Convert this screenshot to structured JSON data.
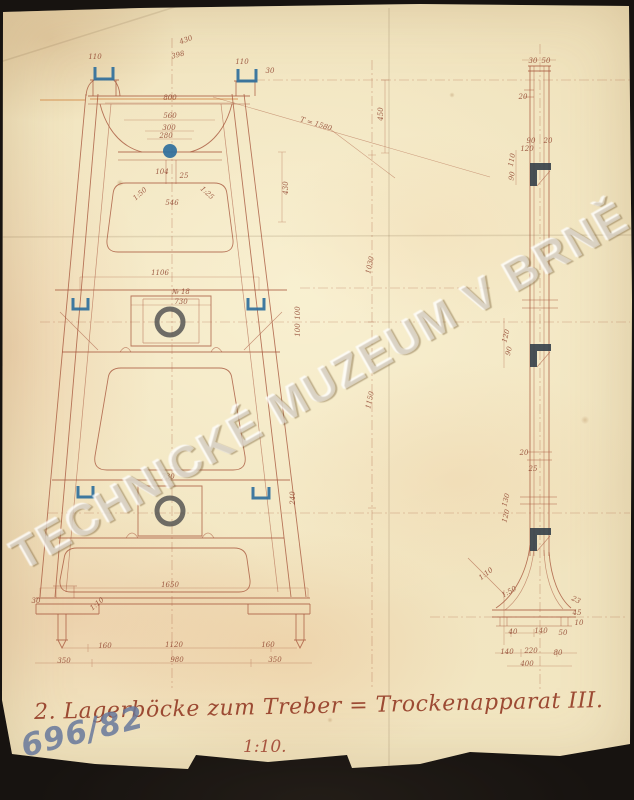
{
  "document": {
    "caption": "2. Lagerböcke zum Treber = Trockenapparat III.",
    "scale_note": "1:10.",
    "archive_number": "696/82",
    "watermark": "TECHNICKÉ MUZEUM V BRNĚ"
  },
  "colors": {
    "paper": "#f0e2bc",
    "ink": "#a8573d",
    "ink_dark": "#8f432e",
    "blue": "#2f6f9c",
    "steel": "#343f49",
    "background": "#171310",
    "watermark_text": "rgba(255,255,255,0.40)"
  },
  "views": {
    "front": {
      "label": "front elevation of bearing pedestal"
    },
    "side": {
      "label": "side elevation of bearing pedestal"
    }
  },
  "dimension_labels": [
    {
      "t": "430",
      "x": 186,
      "y": 40,
      "r": -20
    },
    {
      "t": "398",
      "x": 178,
      "y": 55,
      "r": -15
    },
    {
      "t": "110",
      "x": 95,
      "y": 57,
      "r": 0
    },
    {
      "t": "110",
      "x": 242,
      "y": 62,
      "r": 0
    },
    {
      "t": "30",
      "x": 270,
      "y": 71,
      "r": 0
    },
    {
      "t": "800",
      "x": 170,
      "y": 98,
      "r": 0
    },
    {
      "t": "560",
      "x": 170,
      "y": 116,
      "r": 0
    },
    {
      "t": "300",
      "x": 169,
      "y": 128,
      "r": 0
    },
    {
      "t": "280",
      "x": 166,
      "y": 136,
      "r": 0
    },
    {
      "t": "T = 1580",
      "x": 316,
      "y": 124,
      "r": 17
    },
    {
      "t": "450",
      "x": 381,
      "y": 114,
      "r": -90
    },
    {
      "t": "104",
      "x": 162,
      "y": 172,
      "r": 0
    },
    {
      "t": "25",
      "x": 184,
      "y": 176,
      "r": 0
    },
    {
      "t": "430",
      "x": 286,
      "y": 188,
      "r": -90
    },
    {
      "t": "1:50",
      "x": 140,
      "y": 194,
      "r": -42
    },
    {
      "t": "1:25",
      "x": 207,
      "y": 193,
      "r": 42
    },
    {
      "t": "546",
      "x": 172,
      "y": 203,
      "r": 0
    },
    {
      "t": "1106",
      "x": 160,
      "y": 273,
      "r": 0
    },
    {
      "t": "№ 18",
      "x": 181,
      "y": 292,
      "r": 0
    },
    {
      "t": "730",
      "x": 181,
      "y": 302,
      "r": 0
    },
    {
      "t": "1030",
      "x": 370,
      "y": 265,
      "r": -78
    },
    {
      "t": "1150",
      "x": 370,
      "y": 400,
      "r": -78
    },
    {
      "t": "100",
      "x": 298,
      "y": 313,
      "r": -90
    },
    {
      "t": "100",
      "x": 298,
      "y": 330,
      "r": -90
    },
    {
      "t": "730",
      "x": 168,
      "y": 477,
      "r": 0
    },
    {
      "t": "240",
      "x": 293,
      "y": 498,
      "r": -90
    },
    {
      "t": "1650",
      "x": 170,
      "y": 585,
      "r": 0
    },
    {
      "t": "30",
      "x": 36,
      "y": 601,
      "r": 0
    },
    {
      "t": "1:10",
      "x": 97,
      "y": 604,
      "r": -40
    },
    {
      "t": "160",
      "x": 105,
      "y": 646,
      "r": 0
    },
    {
      "t": "1120",
      "x": 174,
      "y": 645,
      "r": 0
    },
    {
      "t": "160",
      "x": 268,
      "y": 645,
      "r": 0
    },
    {
      "t": "350",
      "x": 64,
      "y": 661,
      "r": 0
    },
    {
      "t": "980",
      "x": 177,
      "y": 660,
      "r": 0
    },
    {
      "t": "350",
      "x": 275,
      "y": 660,
      "r": 0
    },
    {
      "t": "30",
      "x": 533,
      "y": 61,
      "r": 0
    },
    {
      "t": "50",
      "x": 546,
      "y": 61,
      "r": 0
    },
    {
      "t": "20",
      "x": 523,
      "y": 97,
      "r": 0
    },
    {
      "t": "90",
      "x": 531,
      "y": 141,
      "r": 0
    },
    {
      "t": "20",
      "x": 548,
      "y": 141,
      "r": 0
    },
    {
      "t": "120",
      "x": 527,
      "y": 149,
      "r": 0
    },
    {
      "t": "110",
      "x": 512,
      "y": 160,
      "r": -80
    },
    {
      "t": "90",
      "x": 512,
      "y": 176,
      "r": -80
    },
    {
      "t": "120",
      "x": 506,
      "y": 336,
      "r": -75
    },
    {
      "t": "90",
      "x": 509,
      "y": 351,
      "r": -75
    },
    {
      "t": "20",
      "x": 524,
      "y": 453,
      "r": 0
    },
    {
      "t": "25",
      "x": 533,
      "y": 469,
      "r": 0
    },
    {
      "t": "130",
      "x": 506,
      "y": 500,
      "r": -75
    },
    {
      "t": "120",
      "x": 506,
      "y": 516,
      "r": -75
    },
    {
      "t": "1:10",
      "x": 486,
      "y": 574,
      "r": -38
    },
    {
      "t": "1:50",
      "x": 509,
      "y": 592,
      "r": -30
    },
    {
      "t": "23",
      "x": 576,
      "y": 600,
      "r": 25
    },
    {
      "t": "45",
      "x": 577,
      "y": 613,
      "r": 0
    },
    {
      "t": "10",
      "x": 579,
      "y": 623,
      "r": 0
    },
    {
      "t": "40",
      "x": 513,
      "y": 632,
      "r": 0
    },
    {
      "t": "140",
      "x": 541,
      "y": 631,
      "r": 0
    },
    {
      "t": "50",
      "x": 563,
      "y": 633,
      "r": 0
    },
    {
      "t": "140",
      "x": 507,
      "y": 652,
      "r": 0
    },
    {
      "t": "220",
      "x": 531,
      "y": 651,
      "r": 0
    },
    {
      "t": "80",
      "x": 558,
      "y": 653,
      "r": 0
    },
    {
      "t": "400",
      "x": 527,
      "y": 664,
      "r": 0
    }
  ]
}
